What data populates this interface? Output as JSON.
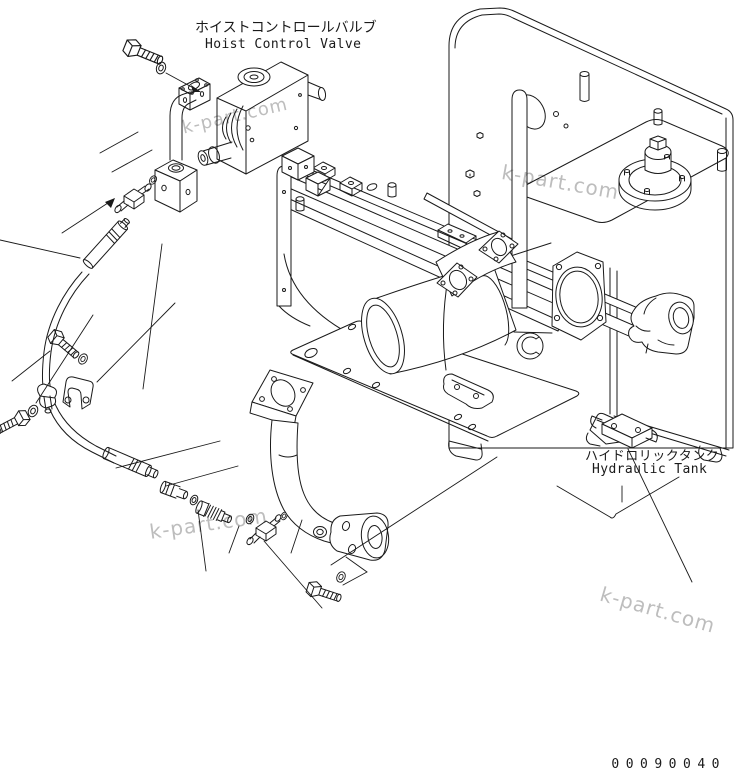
{
  "page": {
    "background": "#ffffff",
    "line_color": "#1a1a1a",
    "watermark_color": "#bdbdbd"
  },
  "labels": {
    "hoist_valve": {
      "jp": "ホイストコントロールバルブ",
      "en": "Hoist Control Valve"
    },
    "hydraulic_tank": {
      "jp": "ハイドロリックタンク",
      "en": "Hydraulic Tank"
    },
    "drawing_number": "00090040",
    "watermark": "k-part.com"
  }
}
